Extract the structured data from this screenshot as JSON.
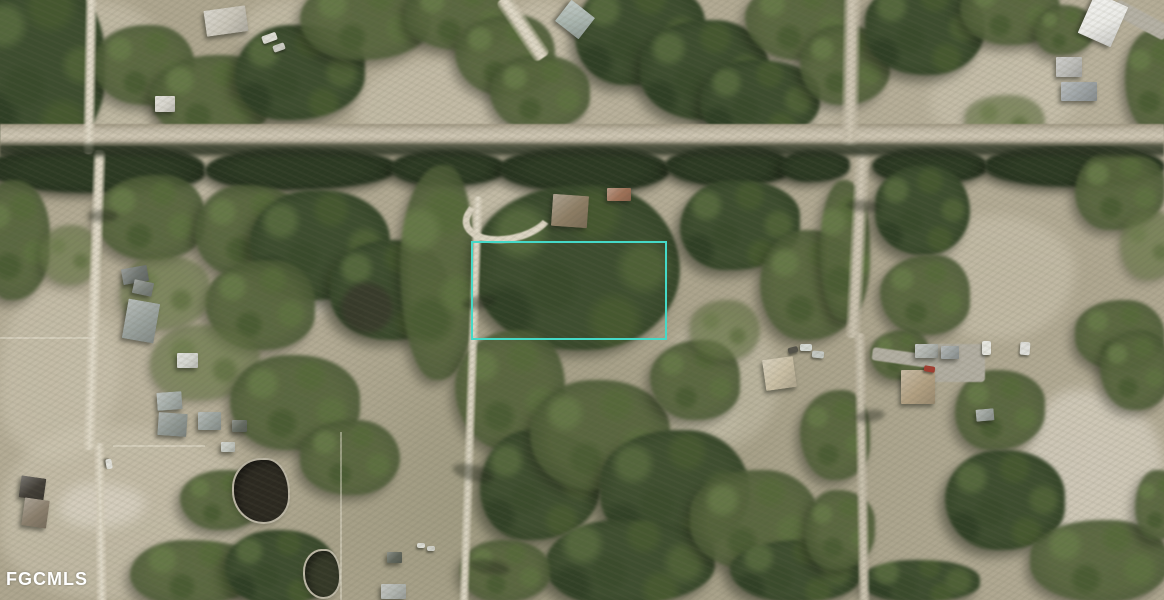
{
  "meta": {
    "width": 1164,
    "height": 600,
    "description": "aerial-parcel-photo"
  },
  "watermark": {
    "text": "FGCMLS",
    "color": "#ffffff"
  },
  "palette": {
    "boundary": "#45d9c7",
    "ground_base": "#aea68f",
    "ground_light": "#cec6b2",
    "road_light": "#dcd5c3",
    "road_main": "#c4bca9",
    "canal_dark": "#3a4230",
    "tree_dark": "#334327",
    "tree_mid": "#55663c",
    "pond_dark": "#2b2820",
    "watermark": "#ffffff"
  },
  "scene": {
    "boundary": {
      "x": 471,
      "y": 241,
      "w": 192,
      "h": 95
    },
    "watermark_pos": {
      "x": 6,
      "y": 570
    },
    "canal": {
      "x": 0,
      "y": 141,
      "w": 1164,
      "h": 18
    },
    "fields": [
      {
        "t": "l",
        "x": 40,
        "y": 0,
        "w": 130,
        "h": 160
      },
      {
        "t": "l",
        "x": 240,
        "y": 0,
        "w": 120,
        "h": 60
      },
      {
        "t": "l",
        "x": 355,
        "y": 60,
        "w": 220,
        "h": 95
      },
      {
        "t": "l",
        "x": 505,
        "y": 0,
        "w": 80,
        "h": 90
      },
      {
        "t": "l",
        "x": 740,
        "y": 60,
        "w": 110,
        "h": 70
      },
      {
        "t": "l",
        "x": 930,
        "y": 50,
        "w": 150,
        "h": 90
      },
      {
        "t": "l",
        "x": 100,
        "y": 152,
        "w": 130,
        "h": 55
      },
      {
        "t": "l",
        "x": 420,
        "y": 165,
        "w": 120,
        "h": 80
      },
      {
        "t": "p",
        "x": 265,
        "y": 195,
        "w": 90,
        "h": 120
      },
      {
        "t": "l",
        "x": 930,
        "y": 215,
        "w": 145,
        "h": 125
      },
      {
        "t": "l",
        "x": 0,
        "y": 290,
        "w": 120,
        "h": 170
      },
      {
        "t": "l",
        "x": 660,
        "y": 320,
        "w": 120,
        "h": 130
      },
      {
        "t": "l",
        "x": 0,
        "y": 425,
        "w": 250,
        "h": 175
      },
      {
        "t": "p",
        "x": 60,
        "y": 483,
        "w": 85,
        "h": 45
      },
      {
        "t": "p",
        "x": 1020,
        "y": 390,
        "w": 144,
        "h": 185
      },
      {
        "t": "l",
        "x": 680,
        "y": 395,
        "w": 60,
        "h": 45
      }
    ],
    "trees": [
      {
        "v": "d",
        "x": -25,
        "y": -25,
        "w": 130,
        "h": 180
      },
      {
        "v": "m",
        "x": 95,
        "y": 25,
        "w": 100,
        "h": 80
      },
      {
        "v": "m",
        "x": 150,
        "y": 55,
        "w": 120,
        "h": 85
      },
      {
        "v": "d",
        "x": 235,
        "y": 25,
        "w": 130,
        "h": 95
      },
      {
        "v": "m",
        "x": 300,
        "y": -20,
        "w": 130,
        "h": 80
      },
      {
        "v": "m",
        "x": 405,
        "y": -20,
        "w": 110,
        "h": 70
      },
      {
        "v": "m",
        "x": 455,
        "y": 15,
        "w": 100,
        "h": 80
      },
      {
        "v": "d",
        "x": 575,
        "y": -20,
        "w": 130,
        "h": 105
      },
      {
        "v": "m",
        "x": 490,
        "y": 55,
        "w": 100,
        "h": 75
      },
      {
        "v": "d",
        "x": 640,
        "y": 20,
        "w": 130,
        "h": 100
      },
      {
        "v": "m",
        "x": 745,
        "y": -20,
        "w": 110,
        "h": 80
      },
      {
        "v": "d",
        "x": 700,
        "y": 60,
        "w": 120,
        "h": 80
      },
      {
        "v": "m",
        "x": 800,
        "y": 25,
        "w": 90,
        "h": 80
      },
      {
        "v": "d",
        "x": 865,
        "y": -20,
        "w": 120,
        "h": 95
      },
      {
        "v": "m",
        "x": 960,
        "y": -25,
        "w": 100,
        "h": 70
      },
      {
        "v": "m",
        "x": 1035,
        "y": 5,
        "w": 60,
        "h": 50
      },
      {
        "v": "m",
        "x": 1125,
        "y": 30,
        "w": 60,
        "h": 100
      },
      {
        "v": "s",
        "x": 965,
        "y": 95,
        "w": 80,
        "h": 50
      },
      {
        "v": "t",
        "x": -15,
        "y": 145,
        "w": 220,
        "h": 48
      },
      {
        "v": "t",
        "x": 205,
        "y": 148,
        "w": 190,
        "h": 42
      },
      {
        "v": "t",
        "x": 390,
        "y": 150,
        "w": 115,
        "h": 36
      },
      {
        "v": "t",
        "x": 500,
        "y": 147,
        "w": 170,
        "h": 45
      },
      {
        "v": "t",
        "x": 665,
        "y": 146,
        "w": 125,
        "h": 40
      },
      {
        "v": "t",
        "x": 780,
        "y": 150,
        "w": 70,
        "h": 32
      },
      {
        "v": "t",
        "x": 872,
        "y": 148,
        "w": 115,
        "h": 36
      },
      {
        "v": "t",
        "x": 985,
        "y": 145,
        "w": 180,
        "h": 42
      },
      {
        "v": "m",
        "x": 95,
        "y": 175,
        "w": 110,
        "h": 85
      },
      {
        "v": "m",
        "x": 195,
        "y": 185,
        "w": 110,
        "h": 90
      },
      {
        "v": "d",
        "x": 250,
        "y": 190,
        "w": 140,
        "h": 110
      },
      {
        "v": "d",
        "x": 330,
        "y": 240,
        "w": 120,
        "h": 100
      },
      {
        "v": "m",
        "x": 205,
        "y": 260,
        "w": 110,
        "h": 90
      },
      {
        "v": "s",
        "x": 120,
        "y": 255,
        "w": 90,
        "h": 75
      },
      {
        "v": "m",
        "x": -20,
        "y": 180,
        "w": 70,
        "h": 120
      },
      {
        "v": "s",
        "x": 40,
        "y": 225,
        "w": 60,
        "h": 60
      },
      {
        "v": "m",
        "x": 400,
        "y": 165,
        "w": 75,
        "h": 215
      },
      {
        "v": "s",
        "x": 150,
        "y": 325,
        "w": 110,
        "h": 75
      },
      {
        "v": "m",
        "x": 230,
        "y": 355,
        "w": 130,
        "h": 95
      },
      {
        "v": "m",
        "x": 300,
        "y": 420,
        "w": 100,
        "h": 75
      },
      {
        "v": "m",
        "x": 180,
        "y": 470,
        "w": 80,
        "h": 60
      },
      {
        "v": "m",
        "x": 130,
        "y": 540,
        "w": 130,
        "h": 65
      },
      {
        "v": "d",
        "x": 225,
        "y": 530,
        "w": 110,
        "h": 75
      },
      {
        "v": "d",
        "x": 475,
        "y": 185,
        "w": 205,
        "h": 165
      },
      {
        "v": "m",
        "x": 455,
        "y": 330,
        "w": 110,
        "h": 120
      },
      {
        "v": "d",
        "x": 480,
        "y": 430,
        "w": 120,
        "h": 110
      },
      {
        "v": "m",
        "x": 530,
        "y": 380,
        "w": 140,
        "h": 110
      },
      {
        "v": "d",
        "x": 600,
        "y": 430,
        "w": 150,
        "h": 120
      },
      {
        "v": "m",
        "x": 650,
        "y": 340,
        "w": 90,
        "h": 80
      },
      {
        "v": "d",
        "x": 545,
        "y": 520,
        "w": 170,
        "h": 85
      },
      {
        "v": "m",
        "x": 460,
        "y": 540,
        "w": 90,
        "h": 62
      },
      {
        "v": "m",
        "x": 690,
        "y": 470,
        "w": 130,
        "h": 100
      },
      {
        "v": "d",
        "x": 730,
        "y": 540,
        "w": 130,
        "h": 62
      },
      {
        "v": "d",
        "x": 680,
        "y": 180,
        "w": 120,
        "h": 90
      },
      {
        "v": "m",
        "x": 760,
        "y": 230,
        "w": 100,
        "h": 110
      },
      {
        "v": "s",
        "x": 690,
        "y": 300,
        "w": 70,
        "h": 60
      },
      {
        "v": "m",
        "x": 800,
        "y": 390,
        "w": 70,
        "h": 90
      },
      {
        "v": "m",
        "x": 805,
        "y": 490,
        "w": 70,
        "h": 80
      },
      {
        "v": "m",
        "x": 820,
        "y": 180,
        "w": 50,
        "h": 140
      },
      {
        "v": "d",
        "x": 875,
        "y": 165,
        "w": 95,
        "h": 90
      },
      {
        "v": "m",
        "x": 880,
        "y": 255,
        "w": 90,
        "h": 80
      },
      {
        "v": "m",
        "x": 1075,
        "y": 150,
        "w": 90,
        "h": 80
      },
      {
        "v": "s",
        "x": 1120,
        "y": 210,
        "w": 60,
        "h": 70
      },
      {
        "v": "m",
        "x": 1075,
        "y": 300,
        "w": 90,
        "h": 70
      },
      {
        "v": "m",
        "x": 870,
        "y": 330,
        "w": 60,
        "h": 50
      },
      {
        "v": "m",
        "x": 955,
        "y": 370,
        "w": 90,
        "h": 80
      },
      {
        "v": "d",
        "x": 945,
        "y": 450,
        "w": 120,
        "h": 100
      },
      {
        "v": "m",
        "x": 1030,
        "y": 520,
        "w": 140,
        "h": 82
      },
      {
        "v": "m",
        "x": 1100,
        "y": 330,
        "w": 70,
        "h": 80
      },
      {
        "v": "m",
        "x": 1135,
        "y": 470,
        "w": 50,
        "h": 70
      },
      {
        "v": "d",
        "x": 860,
        "y": 560,
        "w": 120,
        "h": 42
      }
    ],
    "ponds": [
      {
        "x": 232,
        "y": 458,
        "w": 54,
        "h": 62,
        "c": "#2b2820",
        "soft": false
      },
      {
        "x": 303,
        "y": 549,
        "w": 34,
        "h": 46,
        "c": "#343827",
        "soft": false
      },
      {
        "x": 341,
        "y": 283,
        "w": 52,
        "h": 50,
        "c": "#383a2b",
        "soft": true
      }
    ],
    "roads": [
      {
        "t": "main",
        "x": 0,
        "y": 124,
        "w": 1164,
        "h": 22,
        "rot": 0
      },
      {
        "t": "bright",
        "x": 84,
        "y": -4,
        "w": 12,
        "h": 158,
        "rot": 1
      },
      {
        "t": "bright",
        "x": 88,
        "y": 150,
        "w": 13,
        "h": 300,
        "rot": 2
      },
      {
        "t": "bright",
        "x": 95,
        "y": 443,
        "w": 11,
        "h": 160,
        "rot": -1
      },
      {
        "t": "bright",
        "x": 466,
        "y": 196,
        "w": 10,
        "h": 408,
        "rot": 2
      },
      {
        "t": "hook",
        "x": 462,
        "y": 188,
        "w": 80,
        "h": 40,
        "rot": -12
      },
      {
        "t": "mid",
        "x": 842,
        "y": -4,
        "w": 18,
        "h": 150,
        "rot": 1
      },
      {
        "t": "mid",
        "x": 850,
        "y": 146,
        "w": 16,
        "h": 192,
        "rot": 3
      },
      {
        "t": "mid",
        "x": 856,
        "y": 333,
        "w": 12,
        "h": 270,
        "rot": -1
      },
      {
        "t": "gray",
        "x": 1112,
        "y": 12,
        "w": 58,
        "h": 16,
        "rot": 28
      },
      {
        "t": "bright",
        "x": 514,
        "y": -8,
        "w": 18,
        "h": 72,
        "rot": -34
      },
      {
        "t": "gray",
        "x": 872,
        "y": 352,
        "w": 72,
        "h": 13,
        "rot": 8
      },
      {
        "t": "pad",
        "x": 925,
        "y": 344,
        "w": 60,
        "h": 38,
        "rot": 0
      }
    ],
    "buildings": [
      {
        "x": 205,
        "y": 8,
        "w": 42,
        "h": 26,
        "rot": -8,
        "c": "#c9c5b9"
      },
      {
        "x": 155,
        "y": 96,
        "w": 20,
        "h": 16,
        "rot": 0,
        "c": "#d6d4cc"
      },
      {
        "x": 560,
        "y": 6,
        "w": 30,
        "h": 27,
        "rot": 38,
        "c": "#a9b5af"
      },
      {
        "x": 1085,
        "y": -2,
        "w": 36,
        "h": 44,
        "rot": 24,
        "c": "#ebebe7"
      },
      {
        "x": 1056,
        "y": 57,
        "w": 26,
        "h": 20,
        "rot": 0,
        "c": "#bcbcb8"
      },
      {
        "x": 1061,
        "y": 82,
        "w": 36,
        "h": 19,
        "rot": 0,
        "c": "#9da3a5"
      },
      {
        "x": 552,
        "y": 195,
        "w": 36,
        "h": 32,
        "rot": 4,
        "c": "#8d7d64"
      },
      {
        "x": 607,
        "y": 188,
        "w": 24,
        "h": 13,
        "rot": 0,
        "c": "#a07258"
      },
      {
        "x": 122,
        "y": 267,
        "w": 26,
        "h": 16,
        "rot": -10,
        "c": "#707672"
      },
      {
        "x": 133,
        "y": 281,
        "w": 20,
        "h": 14,
        "rot": 12,
        "c": "#7e847e"
      },
      {
        "x": 125,
        "y": 301,
        "w": 32,
        "h": 40,
        "rot": 10,
        "c": "#99a19d"
      },
      {
        "x": 177,
        "y": 353,
        "w": 21,
        "h": 15,
        "rot": 0,
        "c": "#d3d5cf"
      },
      {
        "x": 157,
        "y": 392,
        "w": 25,
        "h": 18,
        "rot": -4,
        "c": "#a4aca8"
      },
      {
        "x": 158,
        "y": 413,
        "w": 29,
        "h": 23,
        "rot": 4,
        "c": "#8f9793"
      },
      {
        "x": 198,
        "y": 412,
        "w": 23,
        "h": 18,
        "rot": 0,
        "c": "#9aa29e"
      },
      {
        "x": 232,
        "y": 420,
        "w": 15,
        "h": 12,
        "rot": 0,
        "c": "#646a61"
      },
      {
        "x": 221,
        "y": 442,
        "w": 14,
        "h": 10,
        "rot": 0,
        "c": "#c4c8c1"
      },
      {
        "x": 20,
        "y": 477,
        "w": 25,
        "h": 22,
        "rot": 8,
        "c": "#413d36"
      },
      {
        "x": 23,
        "y": 499,
        "w": 25,
        "h": 28,
        "rot": 8,
        "c": "#8b7f6d"
      },
      {
        "x": 901,
        "y": 370,
        "w": 34,
        "h": 34,
        "rot": 0,
        "c": "#b5a284"
      },
      {
        "x": 915,
        "y": 344,
        "w": 23,
        "h": 14,
        "rot": 0,
        "c": "#b0b4b0"
      },
      {
        "x": 941,
        "y": 346,
        "w": 18,
        "h": 13,
        "rot": 0,
        "c": "#9ca2a2"
      },
      {
        "x": 764,
        "y": 358,
        "w": 31,
        "h": 31,
        "rot": -8,
        "c": "#d0c4aa"
      },
      {
        "x": 381,
        "y": 584,
        "w": 25,
        "h": 15,
        "rot": 0,
        "c": "#b2b6b2"
      },
      {
        "x": 387,
        "y": 552,
        "w": 15,
        "h": 11,
        "rot": 0,
        "c": "#60665d"
      },
      {
        "x": 976,
        "y": 409,
        "w": 18,
        "h": 12,
        "rot": -5,
        "c": "#9da39f"
      }
    ],
    "vehicles": [
      {
        "x": 262,
        "y": 34,
        "w": 15,
        "h": 8,
        "rot": -20,
        "c": "#dddcd4"
      },
      {
        "x": 273,
        "y": 44,
        "w": 12,
        "h": 7,
        "rot": -20,
        "c": "#cbcbc3"
      },
      {
        "x": 104,
        "y": 461,
        "w": 10,
        "h": 6,
        "rot": 80,
        "c": "#e2e2dc"
      },
      {
        "x": 924,
        "y": 366,
        "w": 11,
        "h": 6,
        "rot": 10,
        "c": "#a43b2f"
      },
      {
        "x": 800,
        "y": 344,
        "w": 12,
        "h": 7,
        "rot": 0,
        "c": "#d9ddd9"
      },
      {
        "x": 812,
        "y": 351,
        "w": 12,
        "h": 7,
        "rot": 5,
        "c": "#c9cdc9"
      },
      {
        "x": 788,
        "y": 347,
        "w": 10,
        "h": 6,
        "rot": -15,
        "c": "#54524a"
      },
      {
        "x": 982,
        "y": 341,
        "w": 9,
        "h": 14,
        "rot": 0,
        "c": "#e7e7e1"
      },
      {
        "x": 1020,
        "y": 342,
        "w": 10,
        "h": 13,
        "rot": 4,
        "c": "#dfdfdb"
      },
      {
        "x": 417,
        "y": 543,
        "w": 8,
        "h": 5,
        "rot": 0,
        "c": "#e1e1db"
      },
      {
        "x": 427,
        "y": 546,
        "w": 8,
        "h": 5,
        "rot": 0,
        "c": "#d6d6d0"
      }
    ],
    "fences": [
      {
        "x": 0,
        "y": 337,
        "w": 95,
        "h": 2
      },
      {
        "x": 113,
        "y": 445,
        "w": 92,
        "h": 2
      },
      {
        "x": 340,
        "y": 432,
        "w": 2,
        "h": 168
      }
    ],
    "shadows": [
      {
        "x": 452,
        "y": 465,
        "w": 42,
        "h": 16,
        "rot": 15
      },
      {
        "x": 462,
        "y": 296,
        "w": 34,
        "h": 13,
        "rot": -10
      },
      {
        "x": 846,
        "y": 200,
        "w": 34,
        "h": 12,
        "rot": 5
      },
      {
        "x": 88,
        "y": 210,
        "w": 30,
        "h": 12,
        "rot": 0
      },
      {
        "x": 855,
        "y": 410,
        "w": 30,
        "h": 12,
        "rot": -8
      },
      {
        "x": 470,
        "y": 560,
        "w": 40,
        "h": 14,
        "rot": 10
      }
    ]
  }
}
